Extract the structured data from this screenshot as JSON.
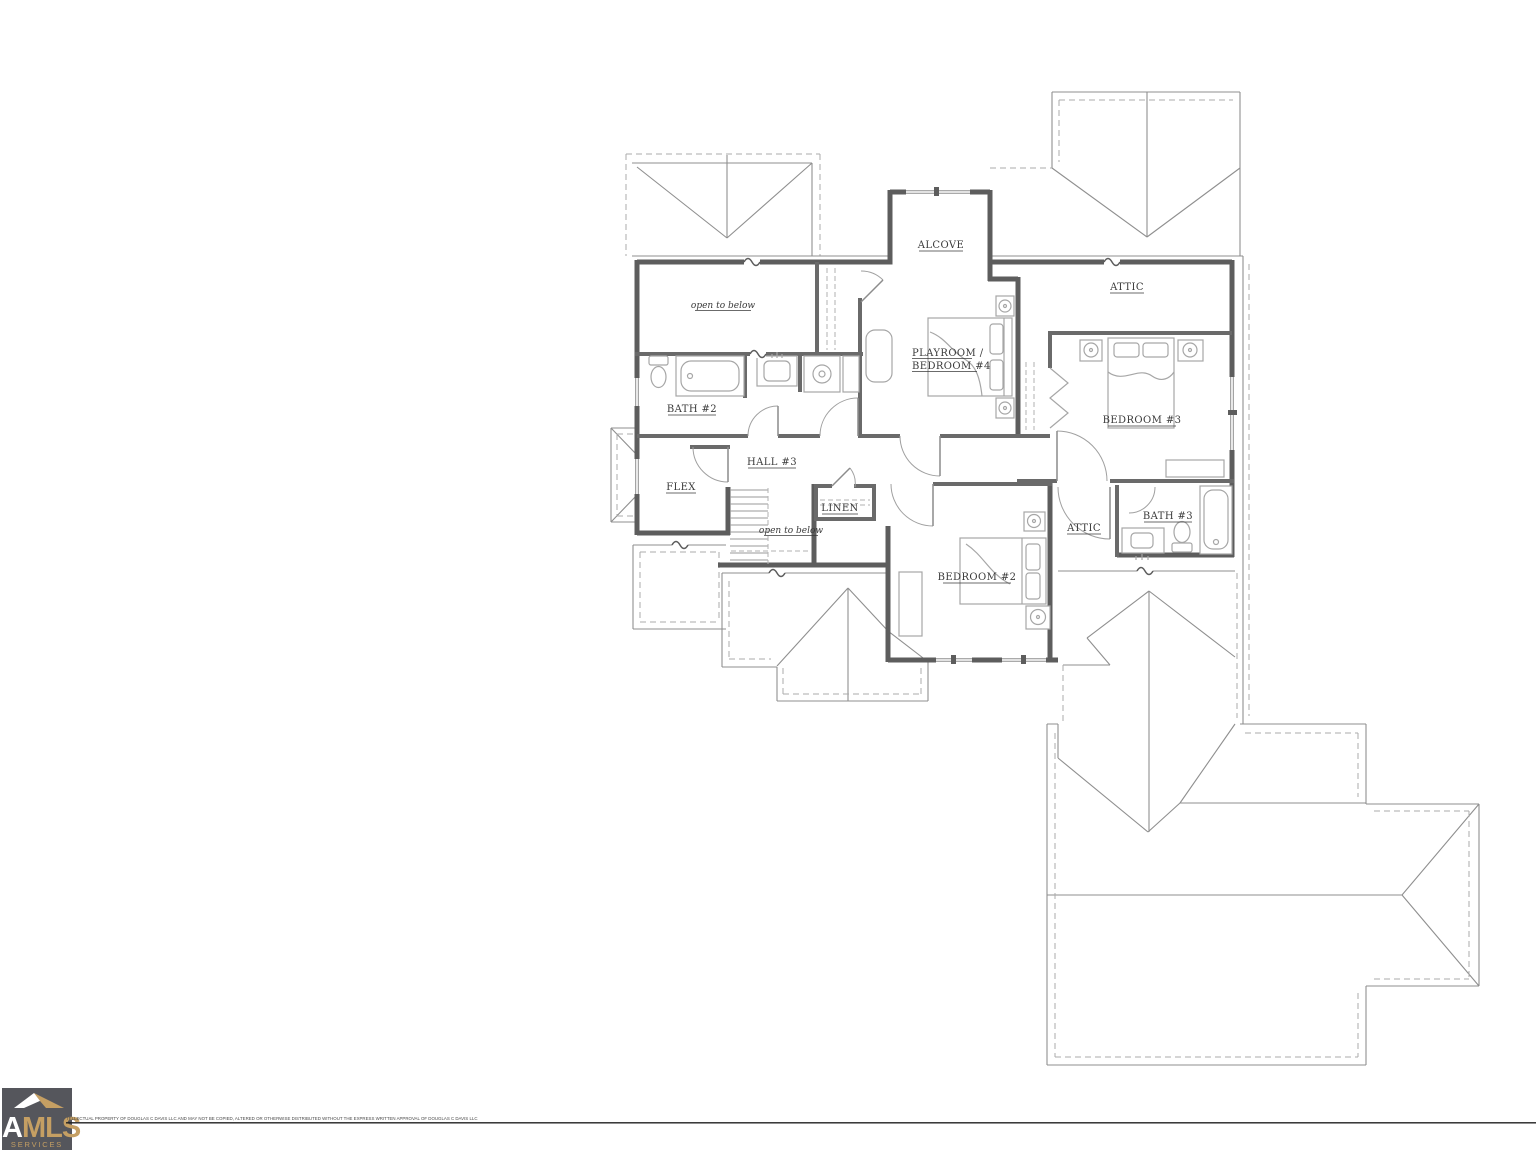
{
  "colors": {
    "wall": "#5d5d5d",
    "iwall": "#6a6a6a",
    "roof": "#8f8f8f",
    "roofdash": "#ababab",
    "fixture": "#a6a6a6",
    "ink": "#3a3a3a",
    "logobg": "#55565c",
    "logoaccent": "#c59f63",
    "rule": "#1f1f1f"
  },
  "labels": {
    "open_to_below_upper": "open to below",
    "alcove": "ALCOVE",
    "attic_upper": "ATTIC",
    "playroom_line1": "PLAYROOM /",
    "playroom_line2": "BEDROOM #4",
    "bath2": "BATH #2",
    "bedroom3": "BEDROOM #3",
    "hall3": "HALL #3",
    "flex": "FLEX",
    "linen": "LINEN",
    "open_to_below_stairs": "open to below",
    "attic_lower": "ATTIC",
    "bath3": "BATH #3",
    "bedroom2": "BEDROOM #2"
  },
  "footer": {
    "logo_text_white": "A",
    "logo_text_accent": "MLS",
    "logo_subtext": "SERVICES",
    "copyright": "TELLECTUAL PROPERTY OF DOUGLAS C DAVIS LLC AND MAY NOT BE COPIED, ALTERED OR OTHERWISE DISTRIBUTED WITHOUT THE EXPRESS WRITTEN APPROVAL OF DOUGLAS C DAVIS LLC"
  }
}
